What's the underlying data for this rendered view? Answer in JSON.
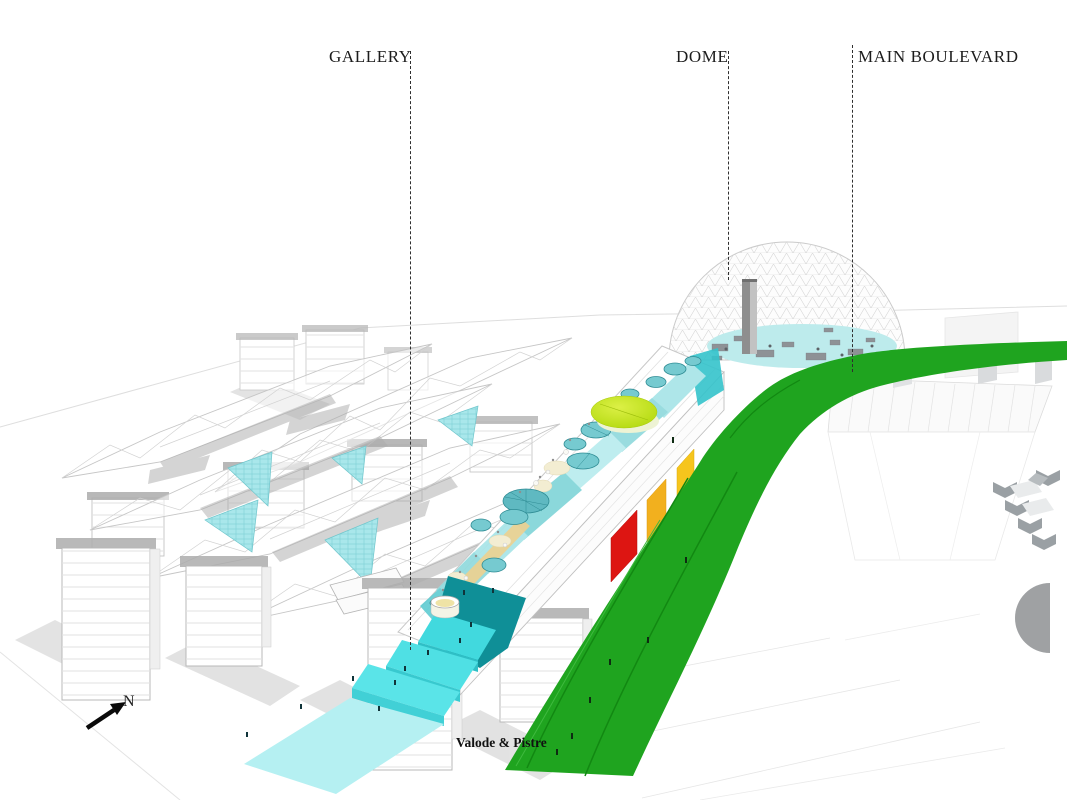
{
  "labels": {
    "gallery": "GALLERY",
    "dome": "DOME",
    "main_boulevard": "MAIN BOULEVARD"
  },
  "compass": {
    "north": "N"
  },
  "credit": {
    "text": "Valode & Pistre"
  },
  "palette": {
    "boulevard_green": "#1FA41F",
    "boulevard_lane_green": "#128812",
    "canal_cyan": "#4ADEE2",
    "canal_pale_cyan": "#B5F0F2",
    "canal_deep_teal": "#0F8F97",
    "dome_pool_cyan": "#BDEBEC",
    "facade_red": "#DD1512",
    "facade_amber": "#F2B01E",
    "event_chartreuse": "#C6E426",
    "glass_cyan": "#A9E7EB",
    "wireframe_gray": "#C6C6C6"
  }
}
